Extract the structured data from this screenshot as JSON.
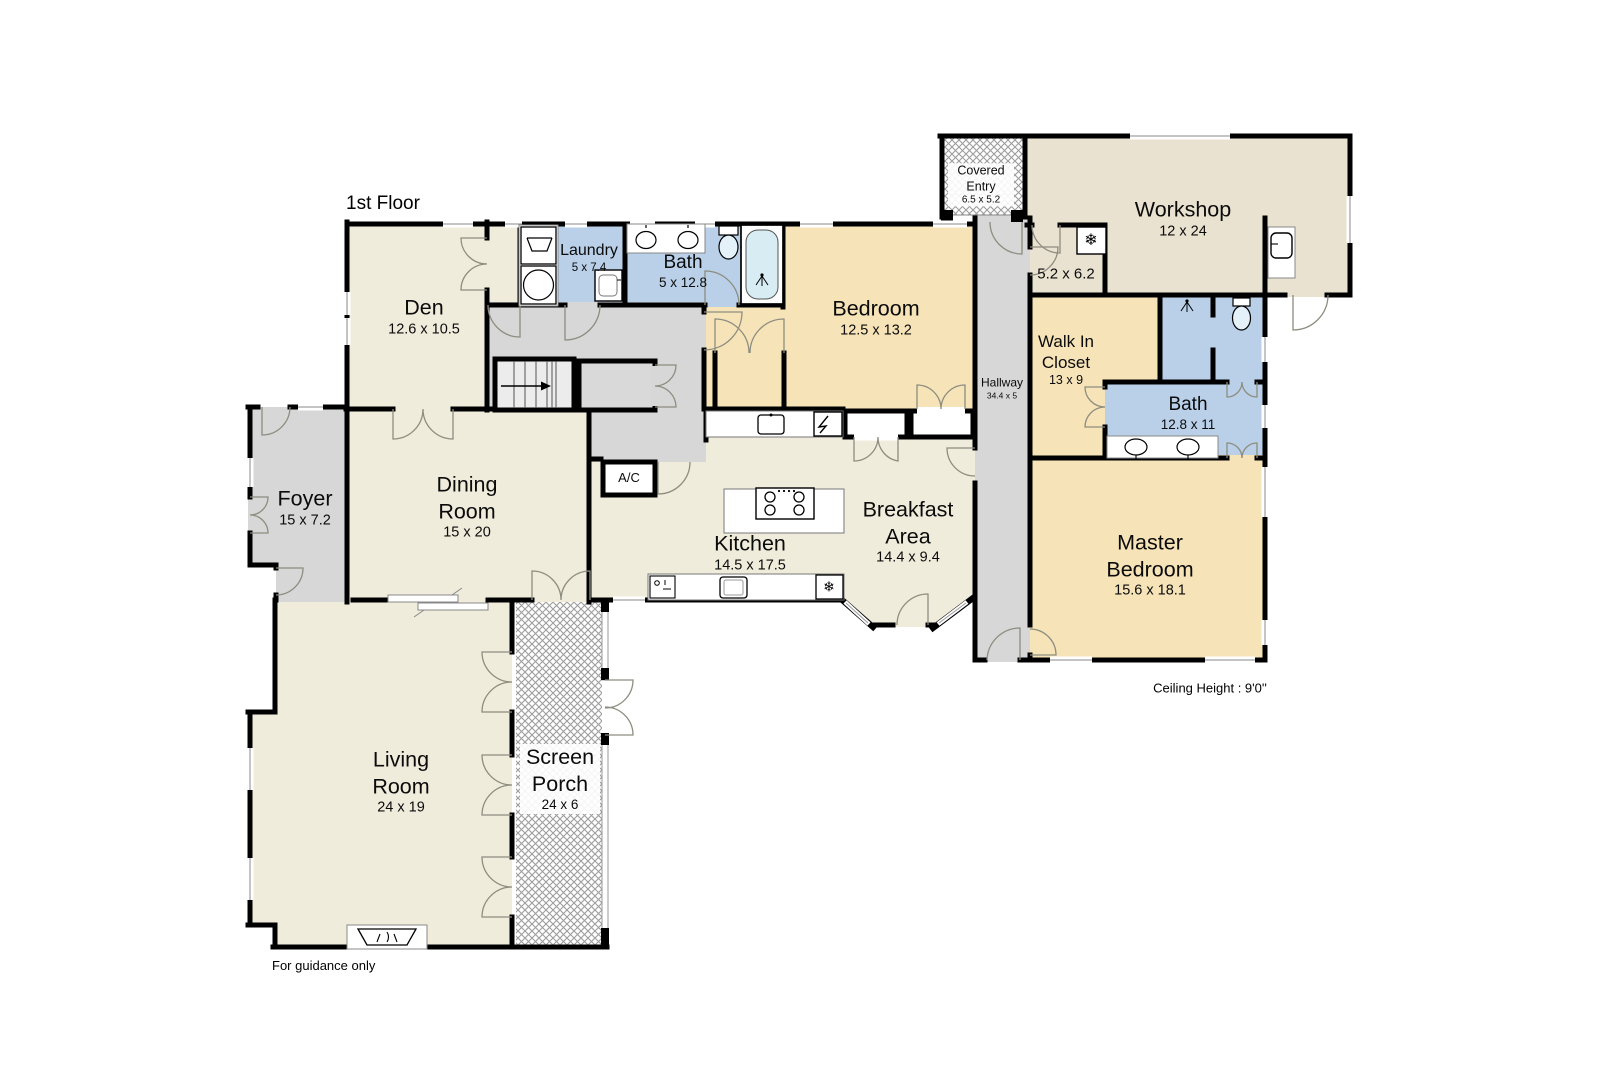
{
  "title": "1st Floor",
  "footnote": "For guidance only",
  "ceiling_note": "Ceiling Height : 9'0''",
  "icons": {
    "snowflake": "❄"
  },
  "colors": {
    "floor_cream": "#f0ecdc",
    "floor_tan": "#f6e4b8",
    "floor_blue": "#b9d0e8",
    "floor_workshop": "#e9e2d0",
    "floor_gray": "#d7d7d7",
    "wall": "#000000"
  },
  "rooms": {
    "den": {
      "name": "Den",
      "dims": "12.6 x 10.5"
    },
    "laundry": {
      "name": "Laundry",
      "dims": "5 x 7.4"
    },
    "bath_upper": {
      "name": "Bath",
      "dims": "5 x 12.8"
    },
    "bedroom": {
      "name": "Bedroom",
      "dims": "12.5 x 13.2"
    },
    "covered_entry": {
      "name": "Covered Entry",
      "dims": "6.5 x 5.2"
    },
    "workshop": {
      "name": "Workshop",
      "dims": "12 x 24"
    },
    "utility_room": {
      "dims": "5.2 x 6.2"
    },
    "walk_in_closet": {
      "name": "Walk In Closet",
      "dims": "13 x 9"
    },
    "master_bath": {
      "name": "Bath",
      "dims": "12.8 x 11"
    },
    "master_bedroom": {
      "name": "Master Bedroom",
      "dims": "15.6 x 18.1"
    },
    "hallway": {
      "name": "Hallway",
      "dims": "34.4 x 5"
    },
    "foyer": {
      "name": "Foyer",
      "dims": "15 x 7.2"
    },
    "dining_room": {
      "name": "Dining Room",
      "dims": "15 x 20"
    },
    "kitchen": {
      "name": "Kitchen",
      "dims": "14.5 x 17.5"
    },
    "breakfast_area": {
      "name": "Breakfast Area",
      "dims": "14.4 x 9.4"
    },
    "living_room": {
      "name": "Living Room",
      "dims": "24 x 19"
    },
    "screen_porch": {
      "name": "Screen Porch",
      "dims": "24 x 6"
    },
    "ac_closet": {
      "label": "A/C"
    }
  }
}
